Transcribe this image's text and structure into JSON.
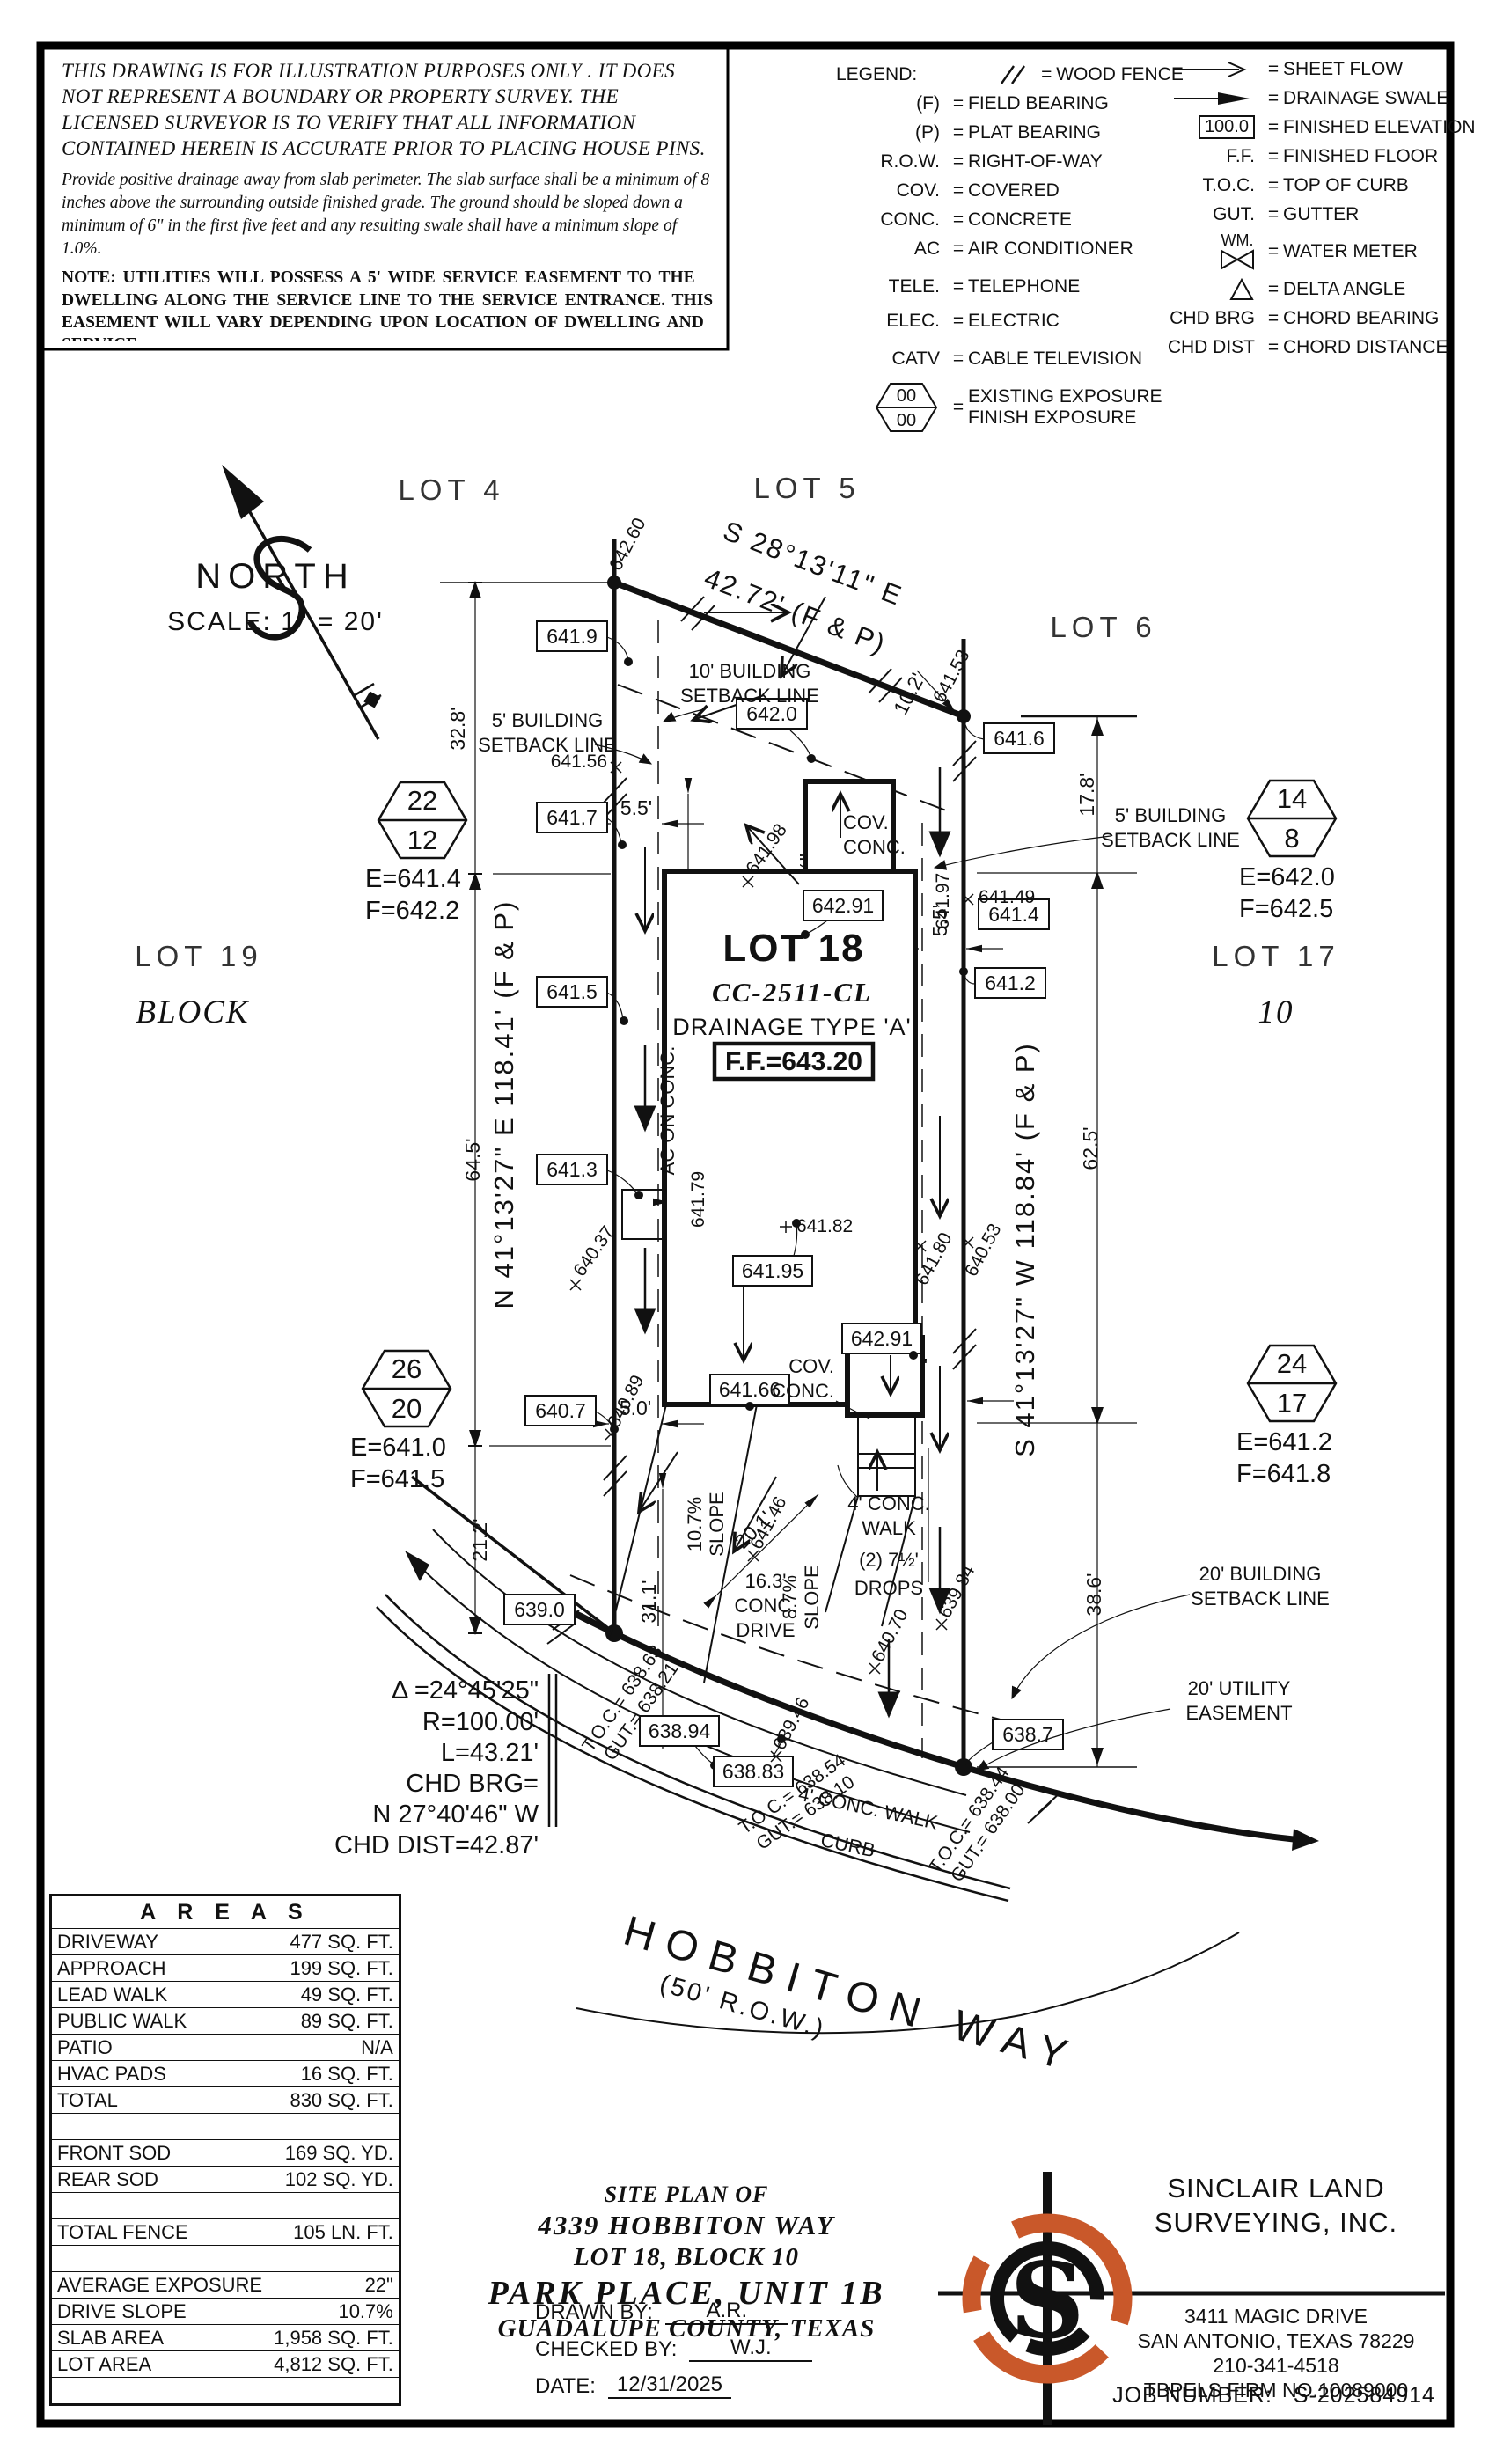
{
  "page": {
    "ink": "#111111",
    "accent": "#c9582a"
  },
  "disclaimer": {
    "p1": "THIS DRAWING IS FOR ILLUSTRATION PURPOSES ONLY . IT DOES NOT REPRESENT A BOUNDARY OR PROPERTY SURVEY. THE LICENSED SURVEYOR IS TO VERIFY THAT ALL INFORMATION CONTAINED HEREIN IS ACCURATE PRIOR TO PLACING HOUSE PINS.",
    "p2": "Provide positive drainage away from slab perimeter. The slab surface shall be a minimum of 8 inches above the surrounding outside finished grade. The ground should be sloped down a minimum of 6\" in the first five feet and any resulting swale shall have a minimum slope of 1.0%.",
    "note": "NOTE: UTILITIES WILL POSSESS A 5' WIDE SERVICE EASEMENT TO THE DWELLING ALONG THE SERVICE LINE TO THE SERVICE ENTRANCE. THIS EASEMENT WILL VARY DEPENDING UPON LOCATION OF DWELLING AND SERVICE."
  },
  "legend": {
    "title": "LEGEND:",
    "eq": "=",
    "left": [
      {
        "sym": "",
        "label": "WOOD FENCE"
      },
      {
        "sym": "(F)",
        "label": "FIELD BEARING"
      },
      {
        "sym": "(P)",
        "label": "PLAT BEARING"
      },
      {
        "sym": "R.O.W.",
        "label": "RIGHT-OF-WAY"
      },
      {
        "sym": "COV.",
        "label": "COVERED"
      },
      {
        "sym": "CONC.",
        "label": "CONCRETE"
      },
      {
        "sym": "AC",
        "label": "AIR CONDITIONER"
      },
      {
        "sym": "TELE.",
        "label": "TELEPHONE"
      },
      {
        "sym": "ELEC.",
        "label": "ELECTRIC"
      },
      {
        "sym": "CATV",
        "label": "CABLE TELEVISION"
      },
      {
        "sym": "00",
        "sym2": "00",
        "label": "EXISTING EXPOSURE",
        "label2": "FINISH EXPOSURE"
      }
    ],
    "right": [
      {
        "sym": "",
        "label": "SHEET FLOW"
      },
      {
        "sym": "",
        "label": "DRAINAGE SWALE"
      },
      {
        "sym": "100.0",
        "label": "FINISHED ELEVATION"
      },
      {
        "sym": "F.F.",
        "label": "FINISHED FLOOR"
      },
      {
        "sym": "T.O.C.",
        "label": "TOP OF CURB"
      },
      {
        "sym": "GUT.",
        "label": "GUTTER"
      },
      {
        "sym": "WM.",
        "label": "WATER METER"
      },
      {
        "sym": "",
        "label": "DELTA ANGLE"
      },
      {
        "sym": "CHD BRG",
        "label": "CHORD BEARING"
      },
      {
        "sym": "CHD DIST",
        "label": "CHORD DISTANCE"
      }
    ]
  },
  "north": {
    "label": "NORTH",
    "scale": "SCALE: 1\" = 20'"
  },
  "lots": {
    "lot4": "LOT 4",
    "lot5": "LOT 5",
    "lot6": "LOT 6",
    "lot19": "LOT 19",
    "lot17": "LOT 17",
    "block": "BLOCK",
    "block_num": "10"
  },
  "site": {
    "lot18": "LOT 18",
    "cc": "CC-2511-CL",
    "drainage": "DRAINAGE TYPE 'A'",
    "ff": "F.F.=643.20"
  },
  "bearings": {
    "top1": "S 28°13'11\" E",
    "top2": "42.72' (F & P)",
    "left": "N 41°13'27\" E 118.41' (F & P)",
    "right": "S 41°13'27\" W 118.84' (F & P)"
  },
  "dims": {
    "d32_8": "32.8'",
    "d64_5": "64.5'",
    "d21_2": "21.2'",
    "d17_8": "17.8'",
    "d62_5": "62.5'",
    "d38_6": "38.6'",
    "d10_2": "10.2'",
    "d5_5l": "5.5'",
    "d5_5r": "5.5'",
    "d5_0l": "5.0'",
    "d5_0r": "5.0'",
    "d29_11": "29'-11\"",
    "d74_5": "74'-5½\"",
    "d20_1": "20.1'",
    "d31_1": "31.1'",
    "d15": "15\"",
    "d2a": "2\"",
    "d2b": "2\"",
    "d2c": "2\"",
    "d3a": "3½\"",
    "d3b": "3½\""
  },
  "boxes": {
    "b641_9": "641.9",
    "b642_0": "642.0",
    "b641_7": "641.7",
    "b641_6": "641.6",
    "b641_4": "641.4",
    "b641_2": "641.2",
    "b641_5": "641.5",
    "b641_3": "641.3",
    "b642_91a": "642.91",
    "b641_95": "641.95",
    "b642_91b": "642.91",
    "b641_66": "641.66",
    "b640_7": "640.7",
    "b639_0": "639.0",
    "b638_94": "638.94",
    "b638_83": "638.83",
    "b638_7": "638.7"
  },
  "spots": {
    "s642_60": "642.60",
    "s641_53": "641.53",
    "s641_56": "641.56",
    "s641_98": "641.98",
    "s641_49": "641.49",
    "s641_97": "641.97",
    "s641_82": "641.82",
    "s641_80": "641.80",
    "s640_53": "640.53",
    "s641_79": "641.79",
    "s640_37": "640.37",
    "s640_89": "640.89",
    "s641_46": "641.46",
    "s639_46": "639.46",
    "s640_70": "640.70",
    "s639_84": "639.84"
  },
  "flags": {
    "nw": {
      "top": "22",
      "bottom": "12",
      "e": "E=641.4",
      "f": "F=642.2"
    },
    "ne": {
      "top": "14",
      "bottom": "8",
      "e": "E=642.0",
      "f": "F=642.5"
    },
    "sw": {
      "top": "26",
      "bottom": "20",
      "e": "E=641.0",
      "f": "F=641.5"
    },
    "se": {
      "top": "24",
      "bottom": "17",
      "e": "E=641.2",
      "f": "F=641.8"
    }
  },
  "callouts": {
    "sb10a": "10' BUILDING",
    "sb10b": "SETBACK LINE",
    "sb5la": "5' BUILDING",
    "sb5lb": "SETBACK LINE",
    "sb5ra": "5' BUILDING",
    "sb5rb": "SETBACK LINE",
    "sb20a": "20' BUILDING",
    "sb20b": "SETBACK LINE",
    "ue20a": "20' UTILITY",
    "ue20b": "EASEMENT",
    "cova": "COV.",
    "conca": "CONC.",
    "covb": "COV.",
    "concb": "CONC.",
    "ac": "AC ON CONC.",
    "walka1": "4' CONC.",
    "walka2": "WALK",
    "drops1": "(2) 7½'",
    "drops2": "DROPS",
    "drive1": "16.3'",
    "drive2": "CONC.",
    "drive3": "DRIVE",
    "slope1a": "10.7%",
    "slope1b": "SLOPE",
    "slope2a": "8.7%",
    "slope2b": "SLOPE",
    "walkb": "4' CONC. WALK",
    "curb": "CURB",
    "toc1a": "T.O.C.= 638.63",
    "toc1b": "GUT.= 638.21",
    "toc2a": "T.O.C.= 638.54",
    "toc2b": "GUT.= 638.10",
    "toc3a": "T.O.C.= 638.44",
    "toc3b": "GUT.= 638.00"
  },
  "street": {
    "name": "HOBBITON WAY",
    "row": "(50' R.O.W.)"
  },
  "curve": {
    "l1": "Δ =24°45'25\"",
    "l2": "R=100.00'",
    "l3": "L=43.21'",
    "l4": "CHD BRG=",
    "l5": "N 27°40'46\" W",
    "l6": "CHD DIST=42.87'"
  },
  "areas": {
    "title": "A R E A S",
    "rows": [
      {
        "l": "DRIVEWAY",
        "v": "477 SQ. FT."
      },
      {
        "l": "APPROACH",
        "v": "199 SQ. FT."
      },
      {
        "l": "LEAD WALK",
        "v": "49 SQ. FT."
      },
      {
        "l": "PUBLIC WALK",
        "v": "89 SQ. FT."
      },
      {
        "l": "PATIO",
        "v": "N/A"
      },
      {
        "l": "HVAC PADS",
        "v": "16 SQ. FT."
      },
      {
        "l": "TOTAL",
        "v": "830 SQ. FT."
      },
      {
        "l": "",
        "v": ""
      },
      {
        "l": "FRONT SOD",
        "v": "169 SQ. YD."
      },
      {
        "l": "REAR SOD",
        "v": "102 SQ. YD."
      },
      {
        "l": "",
        "v": ""
      },
      {
        "l": "TOTAL FENCE",
        "v": "105 LN. FT."
      },
      {
        "l": "",
        "v": ""
      },
      {
        "l": "AVERAGE EXPOSURE",
        "v": "22\""
      },
      {
        "l": "DRIVE SLOPE",
        "v": "10.7%"
      },
      {
        "l": "SLAB AREA",
        "v": "1,958 SQ. FT."
      },
      {
        "l": "LOT AREA",
        "v": "4,812 SQ. FT."
      },
      {
        "l": "",
        "v": ""
      }
    ]
  },
  "titleblock": {
    "l1": "SITE PLAN OF",
    "l2": "4339 HOBBITON WAY",
    "l3": "LOT 18, BLOCK 10",
    "l4": "PARK PLACE, UNIT 1B",
    "l5": "GUADALUPE COUNTY, TEXAS",
    "drawn_label": "DRAWN BY:",
    "drawn": "A.R.",
    "checked_label": "CHECKED BY:",
    "checked": "W.J.",
    "date_label": "DATE:",
    "date": "12/31/2025"
  },
  "company": {
    "name1": "SINCLAIR LAND",
    "name2": "SURVEYING, INC.",
    "addr1": "3411 MAGIC DRIVE",
    "addr2": "SAN ANTONIO, TEXAS 78229",
    "phone": "210-341-4518",
    "firm": "TBPELS FIRM NO.10089000",
    "job_label": "JOB NUMBER:",
    "job": "S-202584914",
    "monogram": "S"
  }
}
